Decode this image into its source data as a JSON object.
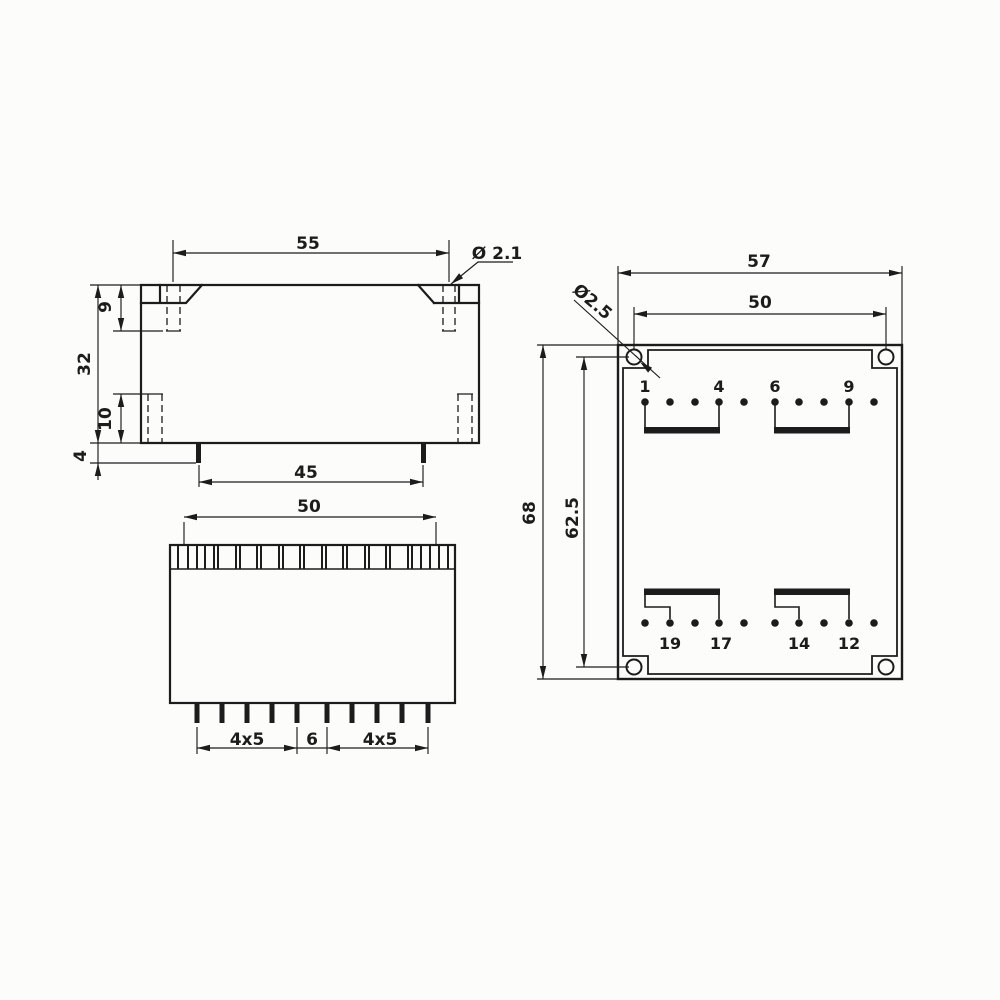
{
  "drawing": {
    "ink_color": "#1c1c1c",
    "background_color": "#fcfcfb",
    "side_view": {
      "dim_55": "55",
      "dia_label": "Ø 2.1",
      "dim_32": "32",
      "dim_9": "9",
      "dim_10": "10",
      "dim_4": "4",
      "dim_45": "45"
    },
    "front_view": {
      "dim_50": "50",
      "dim_pitch_left": "4x5",
      "dim_gap": "6",
      "dim_pitch_right": "4x5"
    },
    "bottom_view": {
      "dim_57": "57",
      "dim_50": "50",
      "dia_label": "Ø2.5",
      "dim_68": "68",
      "dim_62_5": "62.5",
      "pin_labels_top": [
        "1",
        "4",
        "6",
        "9"
      ],
      "pin_labels_bottom": [
        "19",
        "17",
        "14",
        "12"
      ]
    }
  }
}
